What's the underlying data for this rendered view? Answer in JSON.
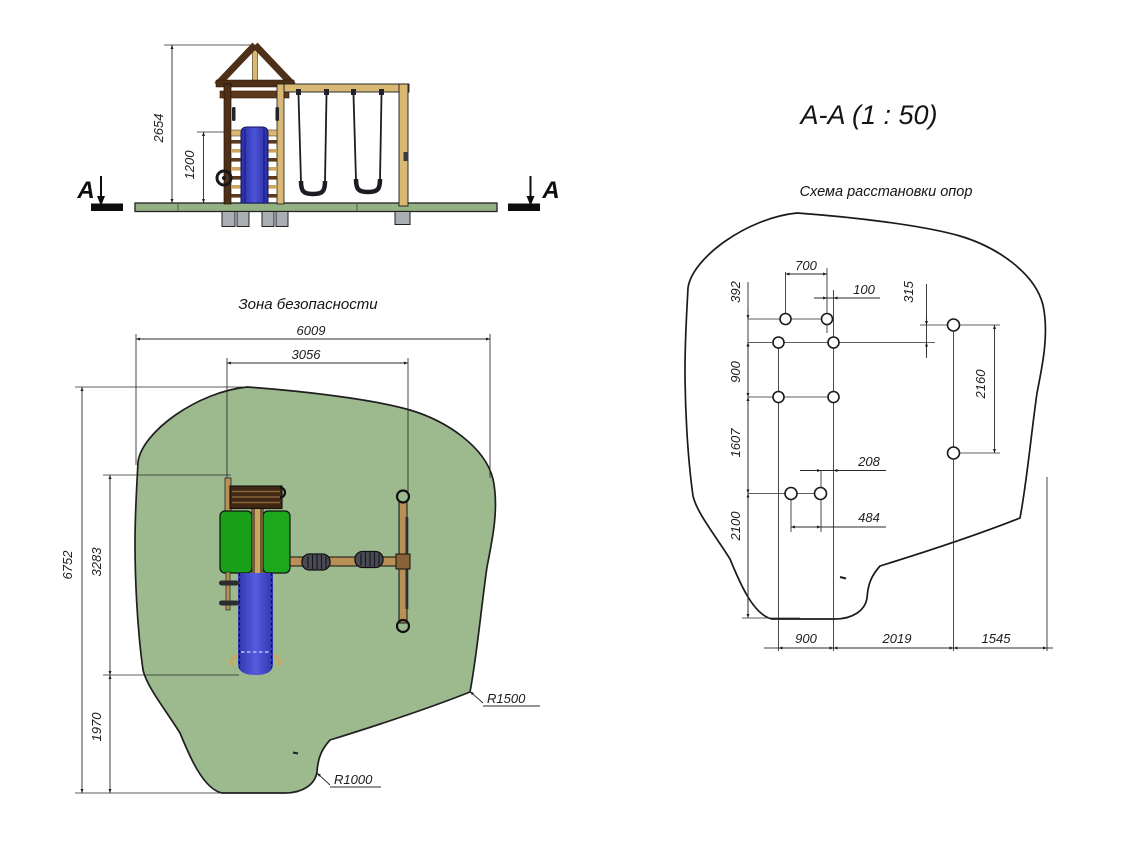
{
  "elevation": {
    "section_marker_left": "A",
    "section_marker_right": "A",
    "dim_height_total": "2654",
    "dim_slide_height": "1200"
  },
  "safety_zone": {
    "title": "Зона безопасности",
    "dim_width_total": "6009",
    "dim_width_inner": "3056",
    "dim_height_total": "6752",
    "dim_height_inner": "3283",
    "dim_height_lower": "1970",
    "label_r1500": "R1500",
    "label_r1000": "R1000"
  },
  "section_view": {
    "title": "A-A (1 : 50)",
    "subtitle": "Схема расстановки опор",
    "dim_700": "700",
    "dim_100": "100",
    "dim_392": "392",
    "dim_315": "315",
    "dim_900_left": "900",
    "dim_2160": "2160",
    "dim_1607": "1607",
    "dim_208": "208",
    "dim_2100": "2100",
    "dim_484": "484",
    "dim_bottom_900": "900",
    "dim_bottom_2019": "2019",
    "dim_bottom_1545": "1545"
  },
  "colors": {
    "safety_zone_fill": "#9cba8e",
    "drawing_line": "#1a1a1a",
    "slide_blue": "#3b41c8",
    "panel_green": "#1ca31c",
    "wood_light": "#d9b873",
    "wood_medium": "#b99055",
    "wood_dark": "#54331a",
    "platform_green": "#93b183",
    "footing_gray": "#a9adb4"
  }
}
